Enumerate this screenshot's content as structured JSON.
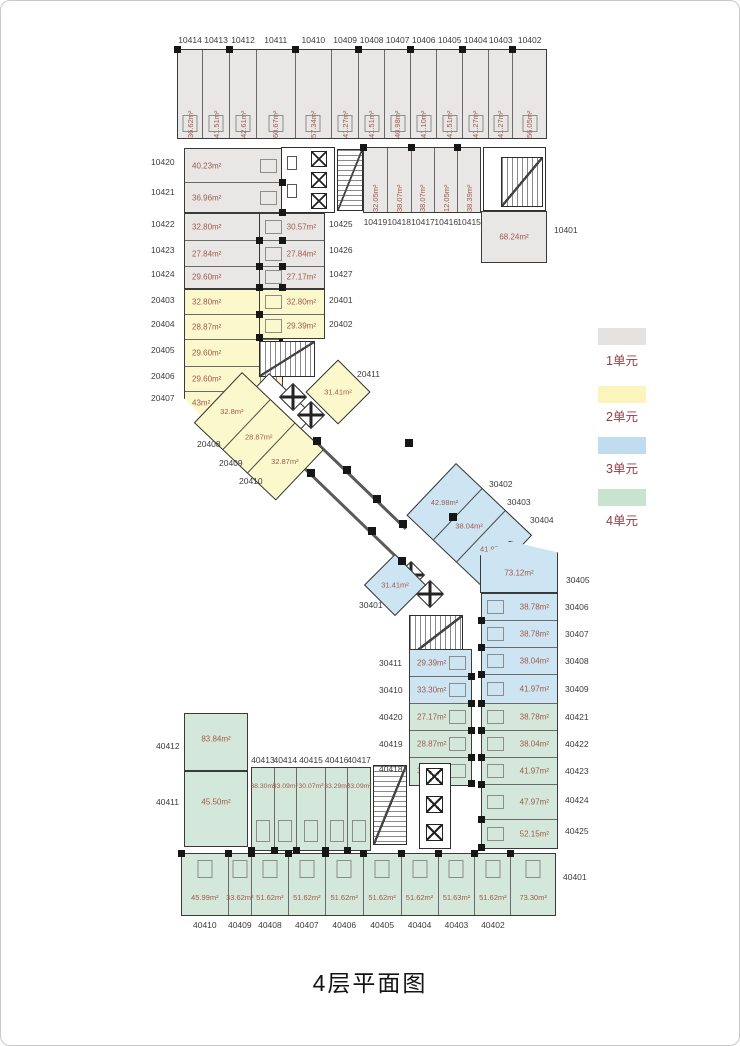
{
  "title": "4层平面图",
  "legend": {
    "items": [
      {
        "label": "1单元",
        "color": "#e4e3e2"
      },
      {
        "label": "2单元",
        "color": "#fbf5bd"
      },
      {
        "label": "3单元",
        "color": "#c2dcef"
      },
      {
        "label": "4单元",
        "color": "#c9e3d1"
      }
    ]
  },
  "colors": {
    "unit1_fill": "#e8e7e5",
    "unit2_fill": "#fbf8cb",
    "unit3_fill": "#cde4f3",
    "unit4_fill": "#d3e8da",
    "area_text": "#a25a49",
    "label_text": "#3c3c3c",
    "legend_text": "#8e3e44",
    "wall": "#3a3a3a"
  },
  "top_row": [
    {
      "no": "10414",
      "area": "36.62m²"
    },
    {
      "no": "10413",
      "area": "41.51m²"
    },
    {
      "no": "10412",
      "area": "42.61m²"
    },
    {
      "no": "10411",
      "area": "60.67m²"
    },
    {
      "no": "10410",
      "area": "57.34m²"
    },
    {
      "no": "10409",
      "area": "41.27m²"
    },
    {
      "no": "10408",
      "area": "41.51m²"
    },
    {
      "no": "10407",
      "area": "40.98m²"
    },
    {
      "no": "10406",
      "area": "41.10m²"
    },
    {
      "no": "10405",
      "area": "41.51m²"
    },
    {
      "no": "10404",
      "area": "41.27m²"
    },
    {
      "no": "10403",
      "area": "41.27m²"
    },
    {
      "no": "10402",
      "area": "56.05m²"
    }
  ],
  "row2_left": [
    {
      "no": "10420",
      "area": "40.23m²"
    },
    {
      "no": "10421",
      "area": "36.96m²"
    }
  ],
  "left_gray": [
    {
      "no": "10422",
      "area": "32.80m²"
    },
    {
      "no": "10423",
      "area": "27.84m²"
    },
    {
      "no": "10424",
      "area": "29.60m²"
    }
  ],
  "left_yellow": [
    {
      "no": "20403",
      "area": "32.80m²"
    },
    {
      "no": "20404",
      "area": "28.87m²"
    },
    {
      "no": "20405",
      "area": "29.60m²"
    },
    {
      "no": "20406",
      "area": "29.60m²"
    },
    {
      "no": "20407",
      "area": "43m²"
    }
  ],
  "mid_gray": [
    {
      "no": "10425",
      "area": "30.57m²"
    },
    {
      "no": "10426",
      "area": "27.84m²"
    },
    {
      "no": "10427",
      "area": "27.17m²"
    }
  ],
  "mid_yellow": [
    {
      "no": "20401",
      "area": "32.80m²"
    },
    {
      "no": "20402",
      "area": "29.39m²"
    }
  ],
  "row2_right": [
    {
      "no": "10419",
      "area": "32.05m²"
    },
    {
      "no": "10418",
      "area": "38.07m²"
    },
    {
      "no": "10417",
      "area": "38.07m²"
    },
    {
      "no": "10416",
      "area": "12.05m²"
    },
    {
      "no": "10415",
      "area": "38.39m²"
    }
  ],
  "u10401": {
    "no": "10401",
    "area": "68.24m²"
  },
  "diag_yellow": [
    {
      "no": "20408",
      "area": "32.8m²"
    },
    {
      "no": "20409",
      "area": "28.87m²"
    },
    {
      "no": "20410",
      "area": "32.87m²"
    }
  ],
  "u20411": {
    "no": "20411",
    "area": "31.41m²"
  },
  "u30401": {
    "no": "30401",
    "area": "31.41m²"
  },
  "diag_blue": [
    {
      "no": "30402",
      "area": "42.98m²"
    },
    {
      "no": "30403",
      "area": "38.04m²"
    },
    {
      "no": "30404",
      "area": "41.97m²"
    }
  ],
  "u30405": {
    "no": "30405",
    "area": "73.12m²"
  },
  "left_stack": [
    {
      "no": "30411",
      "area": "29.39m²"
    },
    {
      "no": "30410",
      "area": "33.30m²"
    },
    {
      "no": "40420",
      "area": "27.17m²"
    },
    {
      "no": "40419",
      "area": "28.87m²"
    },
    {
      "no": "40418",
      "area": "30.57m²"
    }
  ],
  "right_stack": [
    {
      "no": "30406",
      "area": "38.78m²"
    },
    {
      "no": "30407",
      "area": "38.78m²"
    },
    {
      "no": "30408",
      "area": "38.04m²"
    },
    {
      "no": "30409",
      "area": "41.97m²"
    },
    {
      "no": "40421",
      "area": "38.78m²"
    },
    {
      "no": "40422",
      "area": "38.04m²"
    },
    {
      "no": "40423",
      "area": "41.97m²"
    },
    {
      "no": "40424",
      "area": "47.97m²"
    },
    {
      "no": "40425",
      "area": "52.15m²"
    }
  ],
  "u40412": {
    "no": "40412",
    "area": "83.84m²"
  },
  "u40411": {
    "no": "40411",
    "area": "45.50m²"
  },
  "mid_green": [
    {
      "no": "40413",
      "area": "38.30m²"
    },
    {
      "no": "40414",
      "area": "33.09m²"
    },
    {
      "no": "40415",
      "area": "30.07m²"
    },
    {
      "no": "40416",
      "area": "33.29m²"
    },
    {
      "no": "40417",
      "area": "33.09m²"
    }
  ],
  "bottom_row": [
    {
      "no": "40410",
      "area": "45.99m²"
    },
    {
      "no": "40409",
      "area": "33.62m²"
    },
    {
      "no": "40408",
      "area": "51.62m²"
    },
    {
      "no": "40407",
      "area": "51.62m²"
    },
    {
      "no": "40406",
      "area": "51.62m²"
    },
    {
      "no": "40405",
      "area": "51.62m²"
    },
    {
      "no": "40404",
      "area": "51.62m²"
    },
    {
      "no": "40403",
      "area": "51.63m²"
    },
    {
      "no": "40402",
      "area": "51.62m²"
    },
    {
      "no": "40401",
      "area": "73.30m²"
    }
  ]
}
